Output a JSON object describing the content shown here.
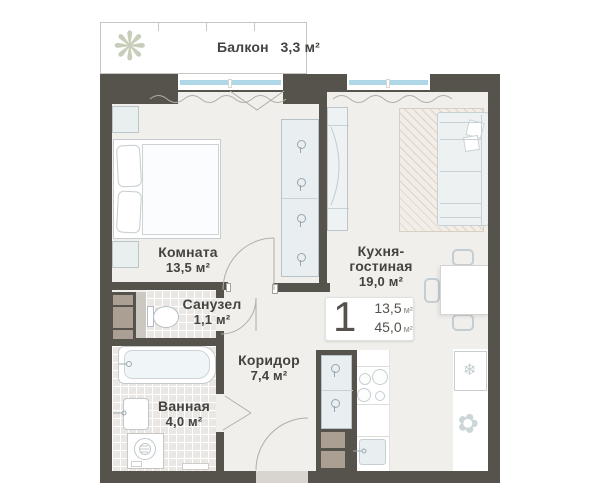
{
  "plan_type": "apartment-floor-plan",
  "badge": {
    "rooms_count": "1",
    "area_living": "13,5",
    "area_total": "45,0",
    "unit": "м²"
  },
  "rooms": [
    {
      "key": "balcony",
      "name": "Балкон",
      "area": "3,3 м²"
    },
    {
      "key": "room",
      "name": "Комната",
      "area": "13,5 м²"
    },
    {
      "key": "kitchen_living",
      "name_line1": "Кухня-",
      "name_line2": "гостиная",
      "area": "19,0 м²"
    },
    {
      "key": "wc",
      "name": "Санузел",
      "area": "1,1 м²"
    },
    {
      "key": "corridor",
      "name": "Коридор",
      "area": "7,4 м²"
    },
    {
      "key": "bath",
      "name": "Ванная",
      "area": "4,0 м²"
    }
  ],
  "icons": {
    "balcony_plant": "❋",
    "fridge_snowflake": "❄",
    "kitchen_plant": "✿"
  },
  "colors": {
    "wall": "#56534d",
    "floor": "#f0efec",
    "tile": "#eae7e4",
    "window_glass": "#aed7e8",
    "shaft": "#ab9f93"
  }
}
